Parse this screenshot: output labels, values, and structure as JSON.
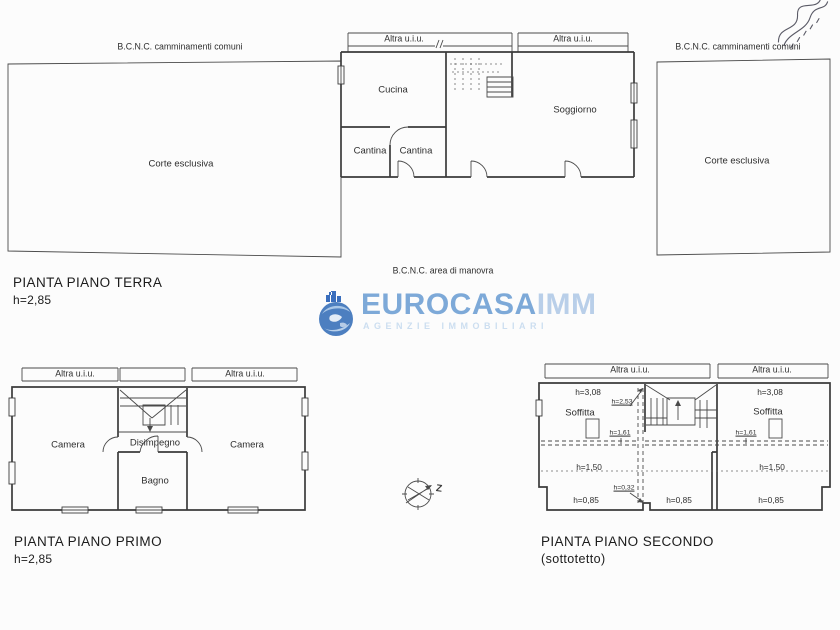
{
  "document": {
    "background": "#fcfcfc",
    "ink": "#3b3b3b"
  },
  "ground_floor": {
    "title": "PIANTA PIANO TERRA",
    "height": "h=2,85",
    "walkway_left": "B.C.N.C. camminamenti comuni",
    "walkway_right": "B.C.N.C. camminamenti comuni",
    "court_left": "Corte esclusiva",
    "court_right": "Corte esclusiva",
    "maneuver_area": "B.C.N.C. area di manovra",
    "unit_labels": [
      "Altra u.i.u.",
      "Altra u.i.u."
    ],
    "rooms": [
      "Cucina",
      "Soggiorno",
      "Cantina",
      "Cantina"
    ]
  },
  "first_floor": {
    "title": "PIANTA PIANO PRIMO",
    "height": "h=2,85",
    "unit_labels": [
      "Altra u.i.u.",
      "Altra u.i.u."
    ],
    "rooms": [
      "Camera",
      "Disimpegno",
      "Camera",
      "Bagno"
    ]
  },
  "second_floor": {
    "title": "PIANTA PIANO SECONDO",
    "subtitle": "(sottotetto)",
    "unit_labels": [
      "Altra u.i.u.",
      "Altra u.i.u."
    ],
    "rooms": [
      "Soffitta",
      "Soffitta"
    ],
    "markers": {
      "h308_left": "h=3,08",
      "h308_right": "h=3,08",
      "h253": "h=2,53",
      "h161_left": "h=1,61",
      "h161_right": "h=1,61",
      "h150_left": "h=1,50",
      "h150_right": "h=1,50",
      "h032": "h=0,32",
      "h085_left": "h=0,85",
      "h085_center": "h=0,85",
      "h085_right": "h=0,85"
    }
  },
  "compass": {
    "label": "Z"
  },
  "watermark": {
    "brand": "EUROCASA",
    "brand_suffix": "IMM",
    "tagline": "AGENZIE IMMOBILIARI",
    "brand_color": "#7da9d8",
    "suffix_color": "#b9cfe9",
    "tagline_color": "#ccdef0",
    "globe_color": "#4d7fc0"
  }
}
